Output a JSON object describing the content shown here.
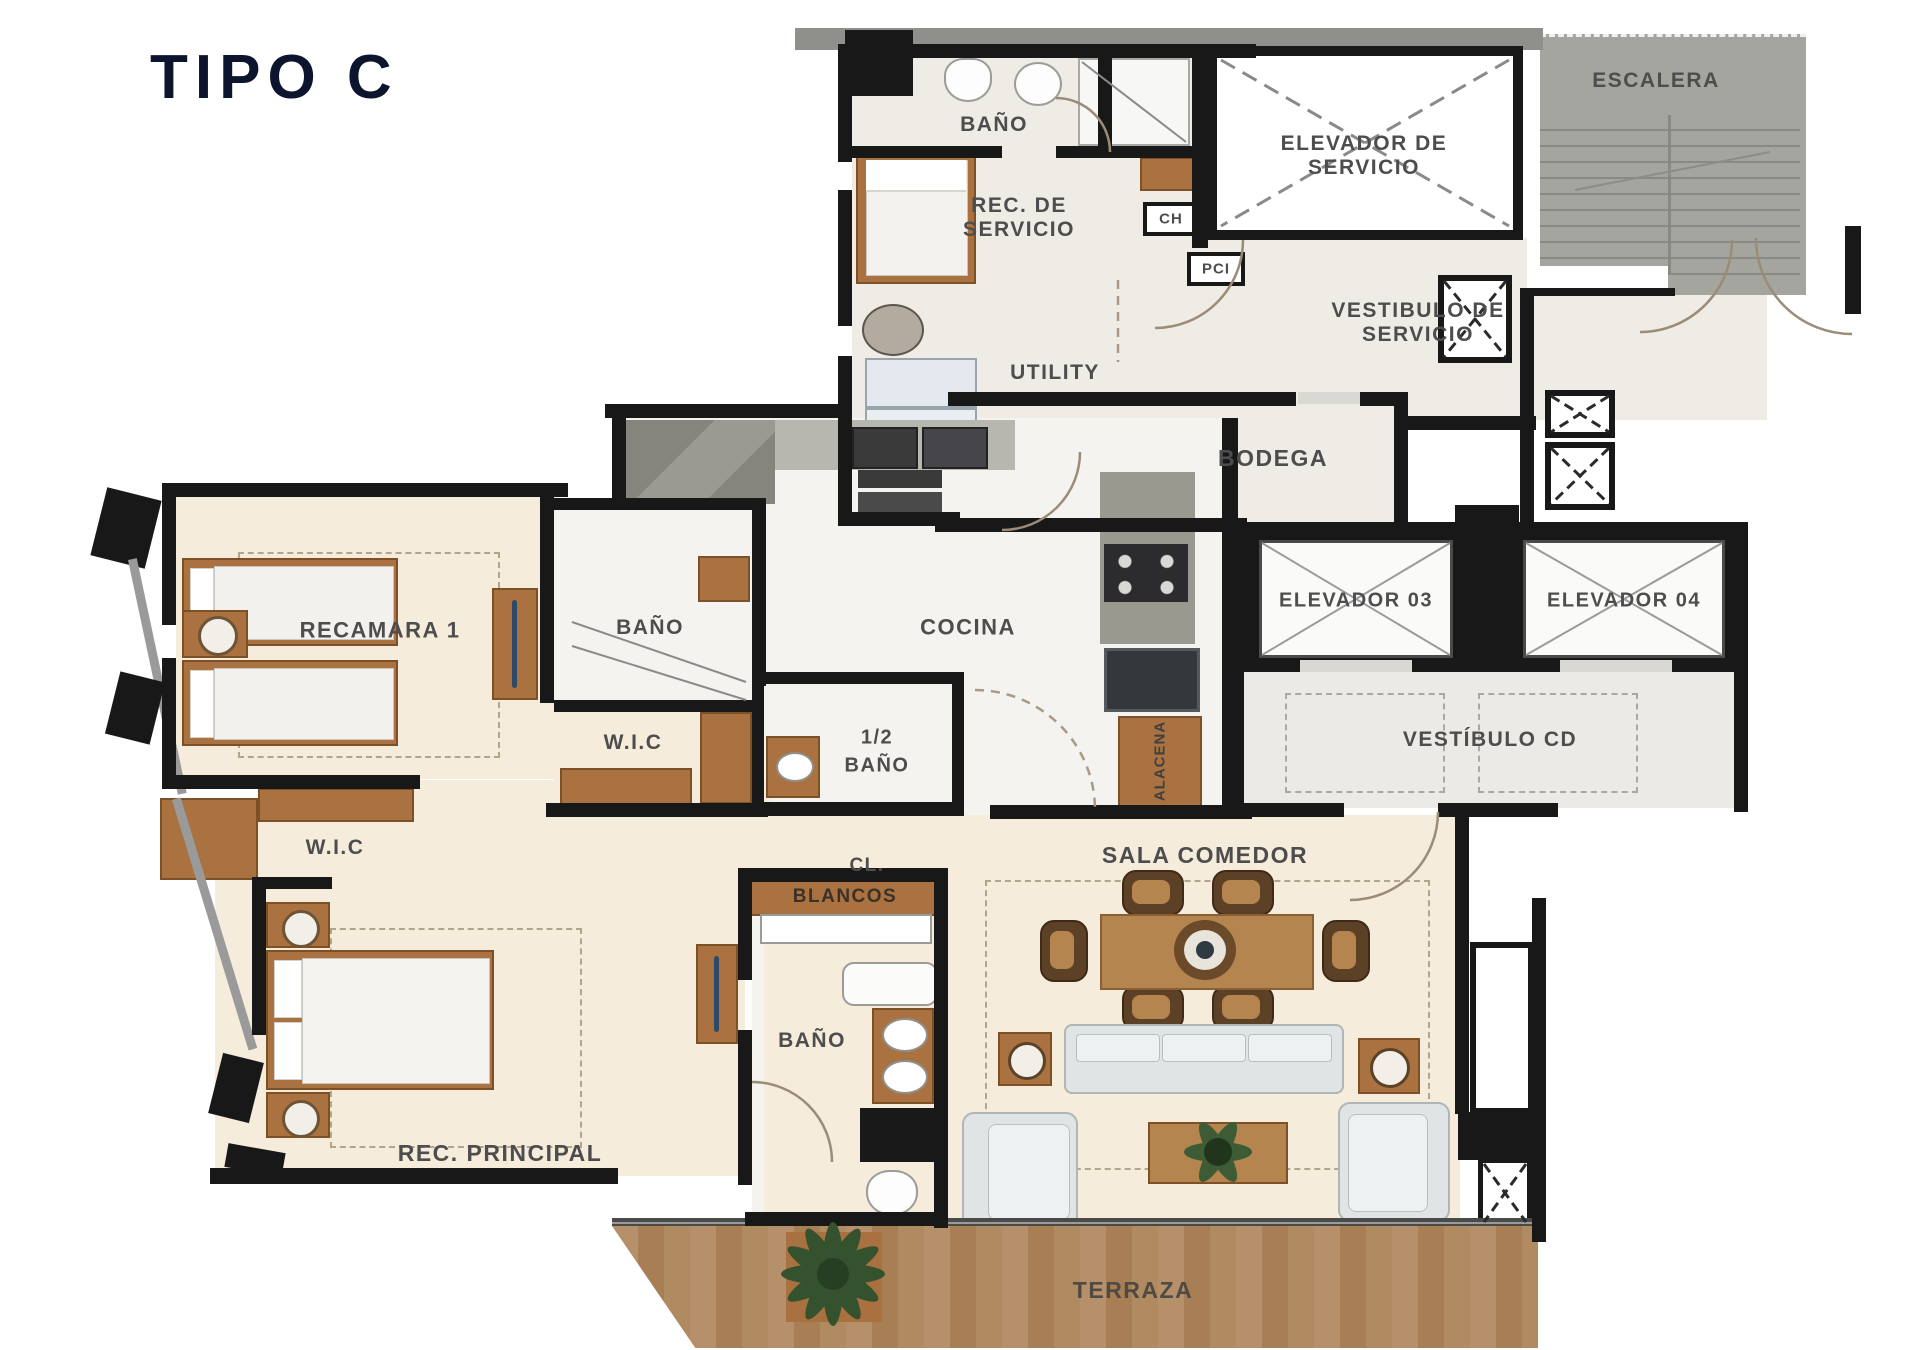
{
  "title": "TIPO C",
  "colors": {
    "title": "#0c142e",
    "wall": "#181818",
    "room_label": "#4d4d4d",
    "floor_bedroom": "#f6ecdb",
    "floor_service": "#efece5",
    "floor_bath": "#f4f3f0",
    "concrete": "#8f8f8b",
    "stair_gray": "#a5a5a0",
    "wood": "#aa7240",
    "deck_wood": "#b08a5e",
    "counter_gray": "#8e8e86",
    "appliance_dark": "#35383b",
    "sofa_fabric": "#e0e4e5",
    "plant_green": "#35522e"
  },
  "rooms": {
    "bano_servicio": "BAÑO",
    "rec_servicio": "REC. DE SERVICIO",
    "ch": "CH",
    "pci": "PCI",
    "elevador_servicio": "ELEVADOR DE SERVICIO",
    "escalera": "ESCALERA",
    "vestibulo_servicio": "VESTIBULO DE SERVICIO",
    "utility": "UTILITY",
    "bodega": "BODEGA",
    "recamara1": "RECAMARA 1",
    "bano_recamara1": "BAÑO",
    "wic_recamara1": "W.I.C",
    "cocina": "COCINA",
    "medio_bano_l1": "1/2",
    "medio_bano_l2": "BAÑO",
    "alacena": "ALACENA",
    "elevador03": "ELEVADOR 03",
    "elevador04": "ELEVADOR 04",
    "vestibulo_cd": "VESTÍBULO CD",
    "wic_principal": "W.I.C",
    "cl": "CL.",
    "blancos": "BLANCOS",
    "sala_comedor": "SALA COMEDOR",
    "bano_principal": "BAÑO",
    "rec_principal": "REC. PRINCIPAL",
    "terraza": "TERRAZA"
  }
}
